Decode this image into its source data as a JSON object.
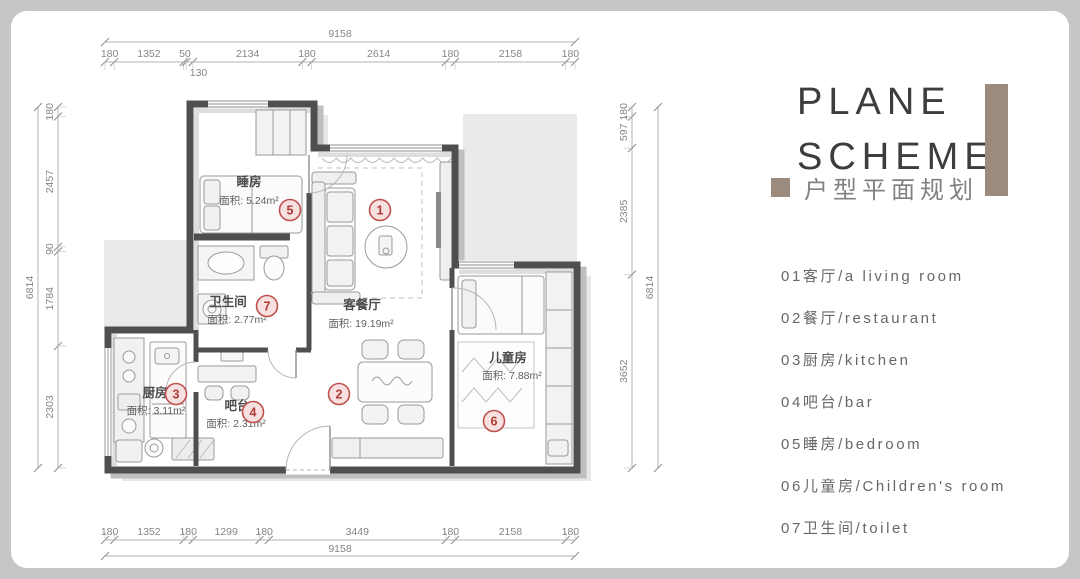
{
  "panel": {
    "title_line1": "PLANE",
    "title_line2": "SCHEME",
    "subtitle": "户型平面规划",
    "accent_color": "#9b8b7f",
    "legend": [
      "01客厅/a living room",
      "02餐厅/restaurant",
      "03厨房/kitchen",
      "04吧台/bar",
      "05睡房/bedroom",
      "06儿童房/Children's room",
      "07卫生间/toilet"
    ]
  },
  "plan": {
    "colors": {
      "wall": "#4f4f4f",
      "shadow_light": "#e7e7e7",
      "shadow_mid": "#bfbfbf",
      "inner_shadow": "#dedede",
      "dim_line": "#b3b3b3",
      "tick": "#8f8f8f",
      "dim_text": "#858585",
      "room_name": "#4a4a4a",
      "room_area": "#5f5f5f",
      "furniture": "#9a9a9a",
      "circle_stroke": "#c0504d",
      "circle_fill": "#f6e1e0",
      "circle_text": "#b03a37"
    },
    "labels": [
      {
        "name": "睡房",
        "area": "面积: 5.24m²",
        "nx": 249,
        "ny": 186,
        "ax": 249,
        "ay": 204
      },
      {
        "name": "卫生间",
        "area": "面积: 2.77m²",
        "nx": 228,
        "ny": 306,
        "ax": 237,
        "ay": 323
      },
      {
        "name": "客餐厅",
        "area": "面积: 19.19m²",
        "nx": 362,
        "ny": 309,
        "ax": 361,
        "ay": 327
      },
      {
        "name": "厨房",
        "area": "面积: 3.11m²",
        "nx": 155,
        "ny": 397,
        "ax": 156,
        "ay": 414
      },
      {
        "name": "吧台",
        "area": "面积: 2.31m²",
        "nx": 237,
        "ny": 410,
        "ax": 236,
        "ay": 427
      },
      {
        "name": "儿童房",
        "area": "面积: 7.88m²",
        "nx": 508,
        "ny": 362,
        "ax": 512,
        "ay": 379
      }
    ],
    "markers": [
      {
        "num": "1",
        "x": 380,
        "y": 210
      },
      {
        "num": "2",
        "x": 339,
        "y": 394
      },
      {
        "num": "3",
        "x": 176,
        "y": 394
      },
      {
        "num": "4",
        "x": 253,
        "y": 412
      },
      {
        "num": "5",
        "x": 290,
        "y": 210
      },
      {
        "num": "6",
        "x": 494,
        "y": 421
      },
      {
        "num": "7",
        "x": 267,
        "y": 306
      }
    ],
    "dimensions": {
      "top": {
        "total": 9158,
        "segments": [
          180,
          1352,
          50,
          130,
          2134,
          180,
          2614,
          180,
          2158,
          180
        ],
        "below_index": 3
      },
      "bottom": {
        "total": 9158,
        "segments": [
          180,
          1352,
          180,
          1299,
          180,
          3449,
          180,
          2158,
          180
        ]
      },
      "left": {
        "total": 6814,
        "segments": [
          180,
          2457,
          90,
          1784,
          2303
        ]
      },
      "right": {
        "total": 6814,
        "segments": [
          180,
          597,
          2385,
          3652
        ]
      }
    }
  }
}
